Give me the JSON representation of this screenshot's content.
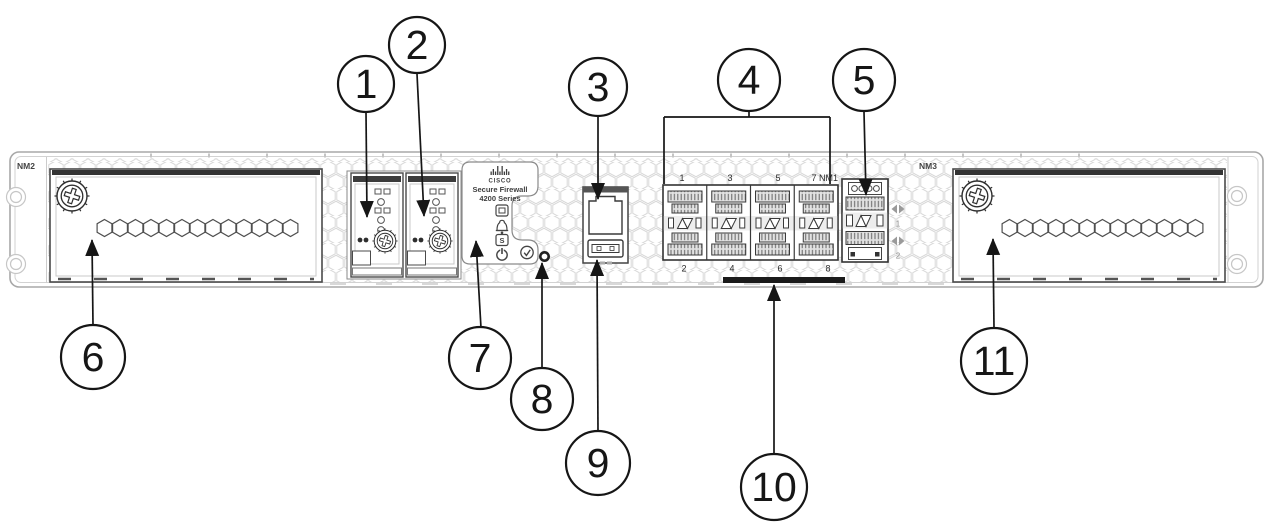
{
  "figure": {
    "device_name": "Cisco Secure Firewall 4200 Series",
    "view": "front-panel-callout-diagram"
  },
  "chassis": {
    "left_module_label": "NM2",
    "right_module_label": "NM3"
  },
  "label_plate": {
    "brand": "CISCO",
    "product_line1": "Secure Firewall",
    "product_line2": "4200 Series",
    "ssd_led_letter": "S"
  },
  "network_ports": {
    "top_labels": [
      "1",
      "3",
      "5",
      "7 NM1"
    ],
    "bottom_labels": [
      "2",
      "4",
      "6",
      "8"
    ]
  },
  "uplink_ports": {
    "labels": [
      "1",
      "2"
    ]
  },
  "callouts": [
    "1",
    "2",
    "3",
    "4",
    "5",
    "6",
    "7",
    "8",
    "9",
    "10",
    "11"
  ],
  "colors": {
    "line": "#161616",
    "chassis_outline": "#a8a8a8",
    "detail": "#3a3a3a",
    "hex_vent": "#d8d8d8"
  }
}
